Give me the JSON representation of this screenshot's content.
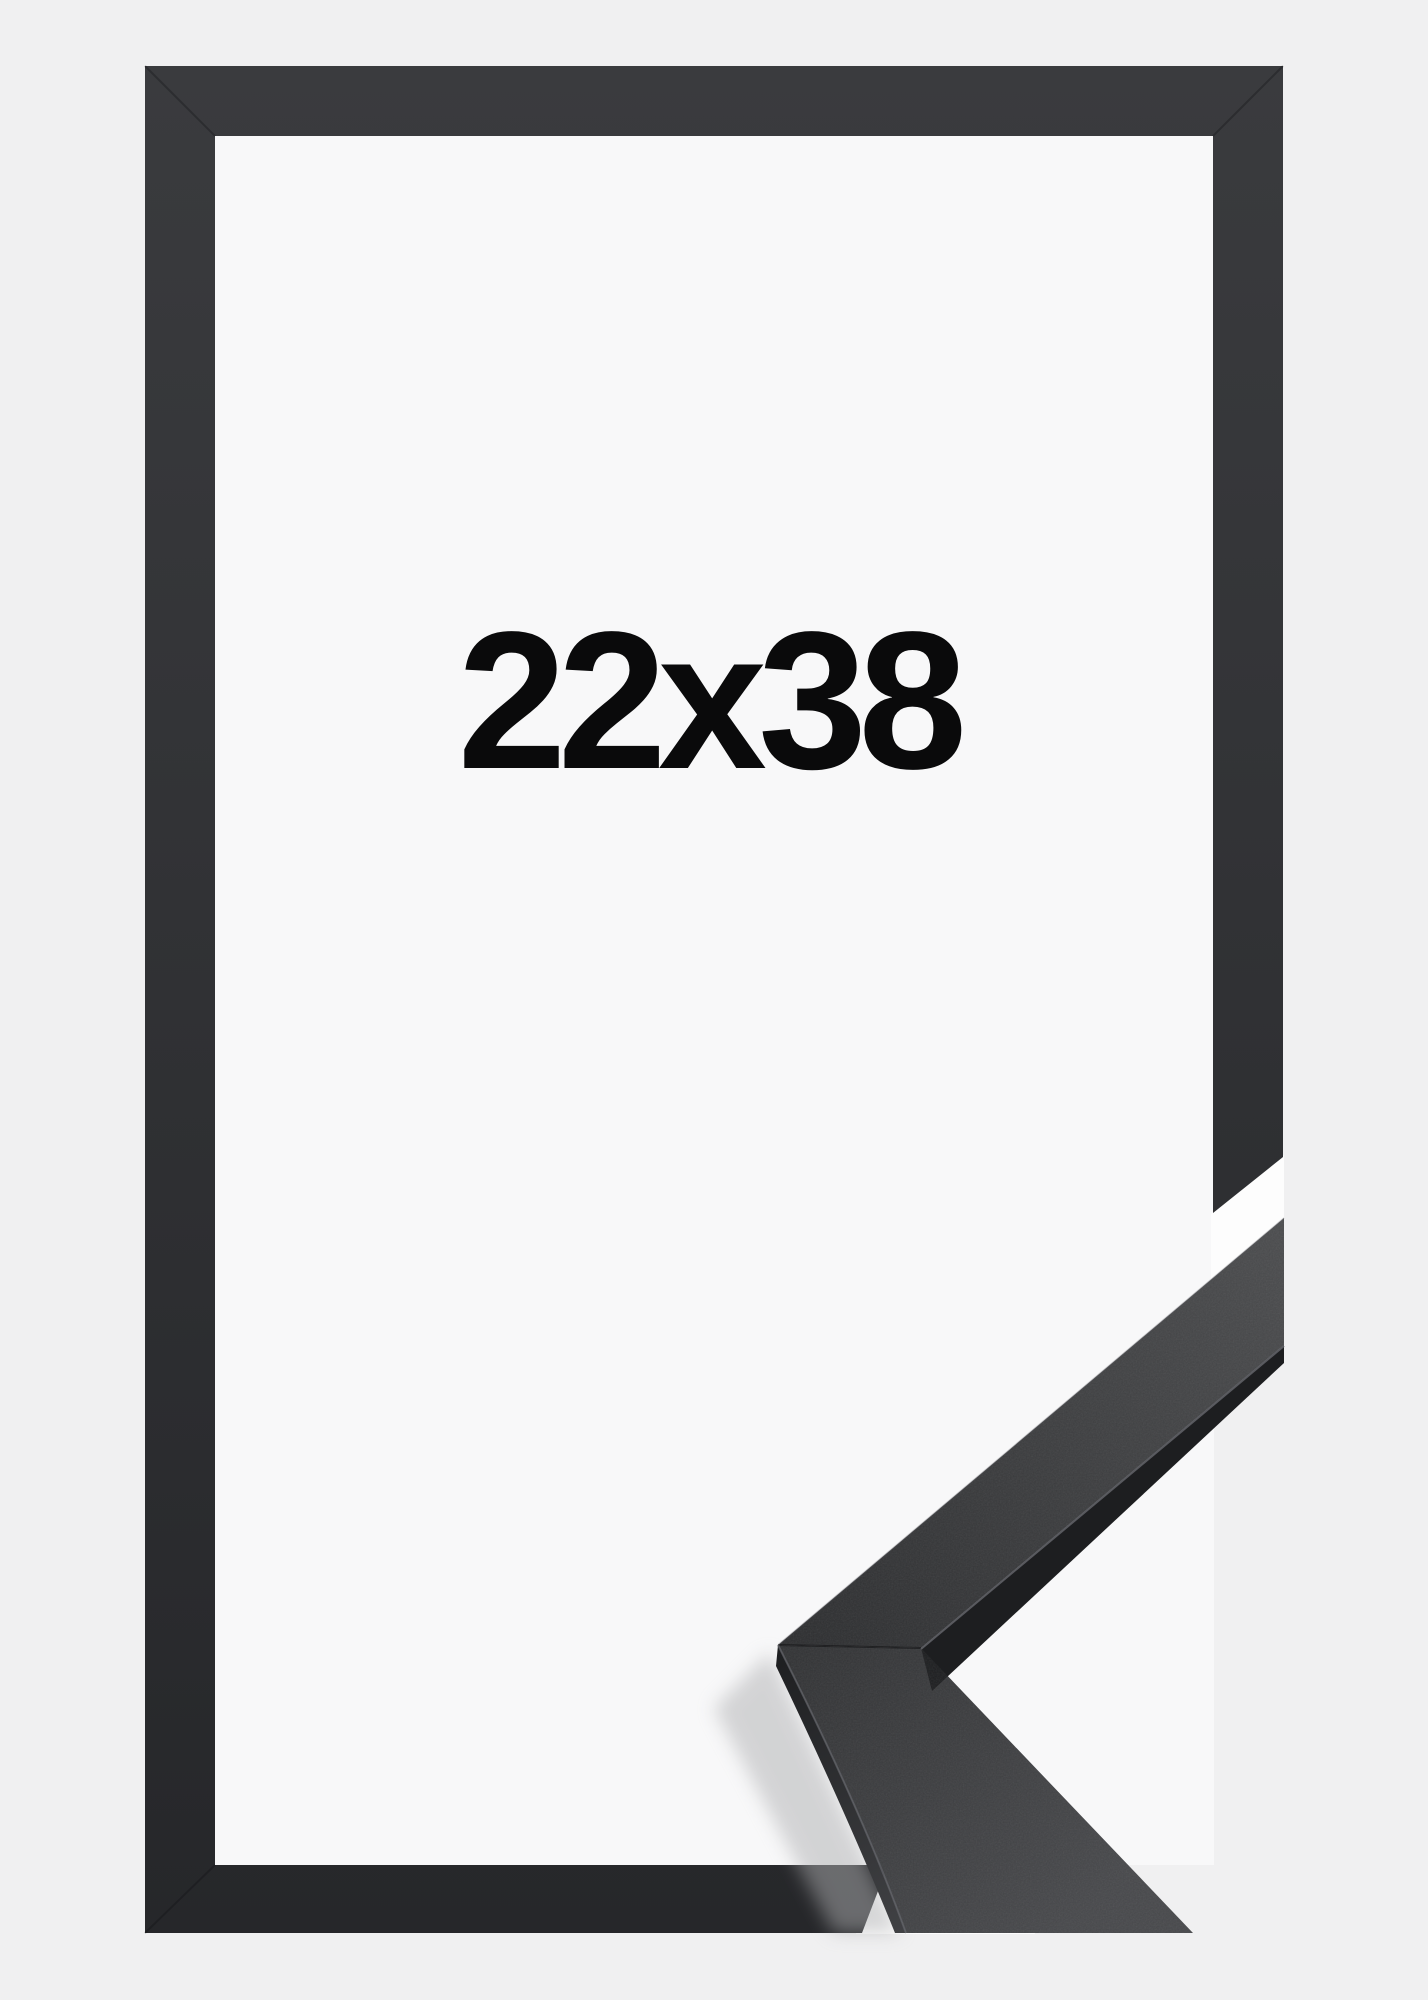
{
  "product": {
    "size_label": "22x38"
  },
  "colors": {
    "background": "#f0f0f1",
    "interior": "#f8f8f9",
    "gap": "#fdfdfd",
    "frame_top": "#3a3b3e",
    "frame_bottom": "#26272a",
    "seam": "#0c0d0f",
    "sample_top_dark": "#2c2d2f",
    "sample_top_light": "#4b4c4e",
    "sample_lower_dark": "#323335",
    "sample_lower_light": "#47484b",
    "sample_front": "#1d1e20",
    "sample_front_light": "#404144",
    "highlight": "#63646a",
    "shadow": "#aeafb1",
    "label": "#0a0a0b"
  }
}
